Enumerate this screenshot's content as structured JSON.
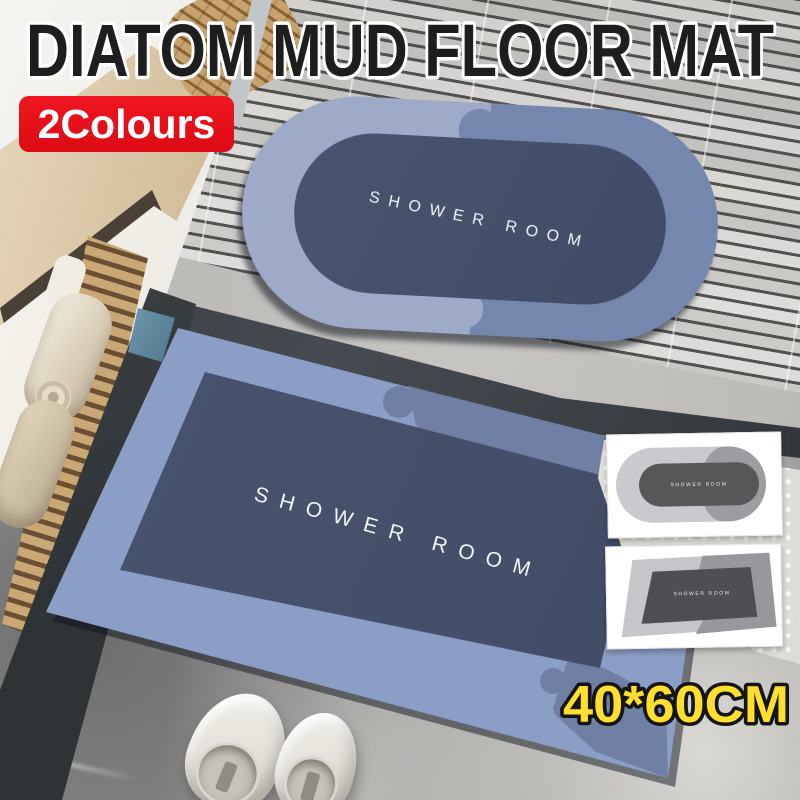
{
  "header": {
    "title": "DIATOM MUD FLOOR MAT",
    "badge_label": "2Colours"
  },
  "size_badge": {
    "label": "40*60CM"
  },
  "mats": {
    "oval": {
      "label": "SHOWER ROOM",
      "shape": "oval"
    },
    "rect": {
      "label": "SHOWER ROOM",
      "shape": "rectangle"
    }
  },
  "thumbnails": [
    {
      "variant": "grey-oval-mat",
      "label": "SHOWER ROOM"
    },
    {
      "variant": "grey-rect-mat",
      "label": "SHOWER ROOM"
    }
  ],
  "colors": {
    "badge_bg": "#e10e15",
    "badge_text": "#ffffff",
    "title_fill": "#1e1e1e",
    "title_outline": "#ffffff",
    "size_text": "#ffdf2e",
    "size_outline": "#141414",
    "mat_border_light": "#9dabc9",
    "mat_border_dark": "#7587ac",
    "mat_center": "#46526c",
    "grey_border_light": "#c9cacd",
    "grey_border_dark": "#9c9da1",
    "grey_center": "#57575a"
  }
}
